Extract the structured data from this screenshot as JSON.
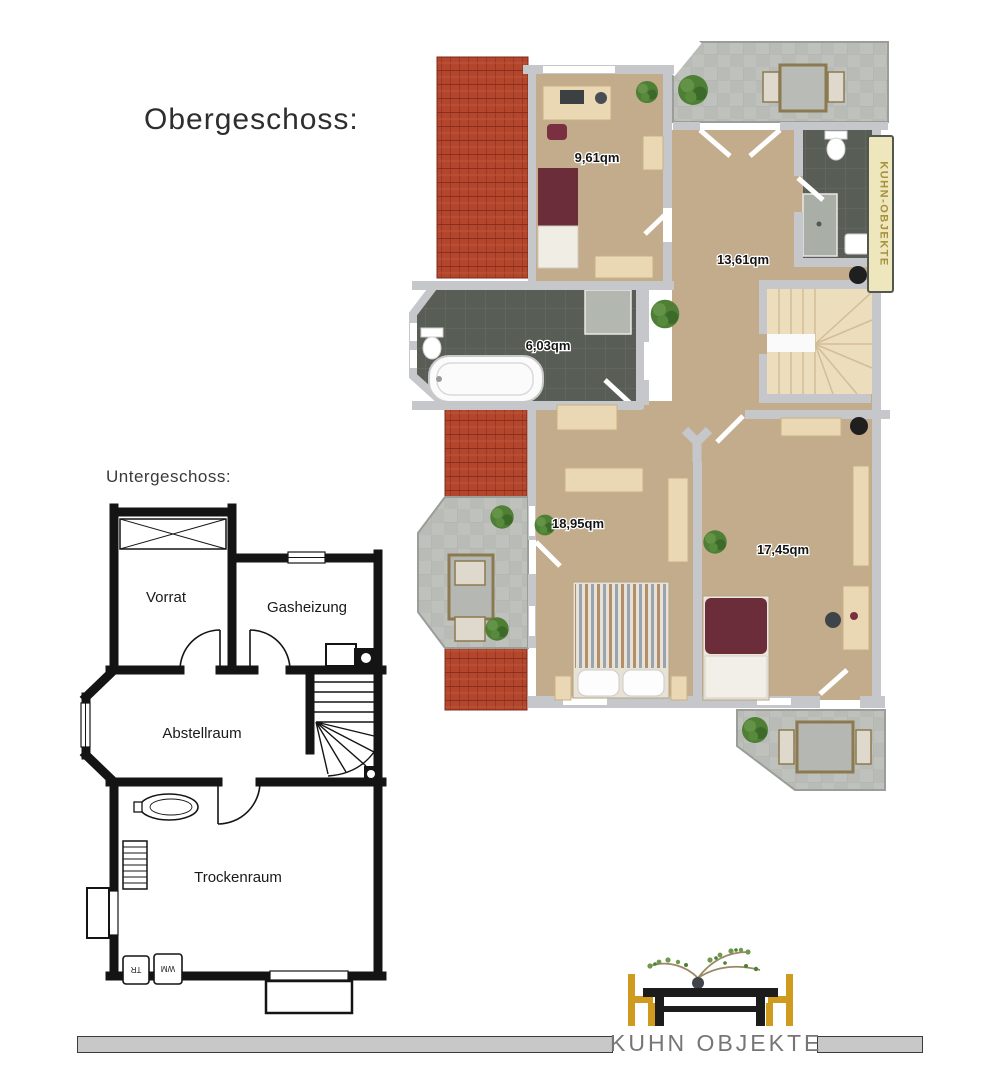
{
  "titles": {
    "obergeschoss": "Obergeschoss:",
    "untergeschoss": "Untergeschoss:"
  },
  "obergeschoss_plan": {
    "room_areas": [
      {
        "room": "bedroom-office",
        "label": "9,61qm"
      },
      {
        "room": "hallway-landing",
        "label": "13,61qm"
      },
      {
        "room": "bathroom",
        "label": "6,03qm"
      },
      {
        "room": "bedroom-main",
        "label": "18,95qm"
      },
      {
        "room": "bedroom-second",
        "label": "17,45qm"
      }
    ],
    "watermark": "KUHN-OBJEKTE"
  },
  "untergeschoss_plan": {
    "room_labels": [
      {
        "room": "storage-room",
        "label": "Vorrat"
      },
      {
        "room": "gas-heating-room",
        "label": "Gasheizung"
      },
      {
        "room": "utility-room",
        "label": "Abstellraum"
      },
      {
        "room": "drying-room",
        "label": "Trockenraum"
      }
    ],
    "appliance_labels": [
      {
        "appliance": "tumble-dryer",
        "label": "TR"
      },
      {
        "appliance": "washing-machine",
        "label": "WM"
      }
    ]
  },
  "footer": {
    "brand": "KUHN OBJEKTE"
  },
  "colors": {
    "roof_tile": "#b3462c",
    "floor_wood": "#c3ac8c",
    "wall_gray": "#c6c7ca",
    "bath_tile_dark": "#585d55",
    "terrace_pavement": "#b9bbb7",
    "bed_red": "#6b2d3a",
    "furniture_wood": "#e9d8b3",
    "stair_wood": "#ecddbd",
    "plant_green": "#4e7f35",
    "logo_gold": "#cf9a1d",
    "logo_black": "#1c1c1c",
    "brand_text_gray": "#767676",
    "footer_bar_gray": "#c8c8c8"
  }
}
